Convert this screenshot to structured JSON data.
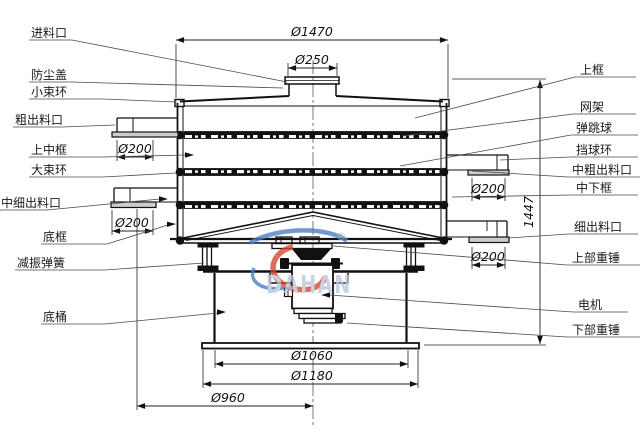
{
  "drawing": {
    "labels_left": [
      {
        "text": "进料口"
      },
      {
        "text": "防尘盖"
      },
      {
        "text": "小束环"
      },
      {
        "text": "粗出料口"
      },
      {
        "text": "上中框"
      },
      {
        "text": "大束环"
      },
      {
        "text": "中细出料口"
      },
      {
        "text": "底框"
      },
      {
        "text": "减振弹簧"
      },
      {
        "text": "底桶"
      }
    ],
    "labels_right": [
      {
        "text": "上框"
      },
      {
        "text": "网架"
      },
      {
        "text": "弹跳球"
      },
      {
        "text": "挡球环"
      },
      {
        "text": "中粗出料口"
      },
      {
        "text": "中下框"
      },
      {
        "text": "细出料口"
      },
      {
        "text": "上部重锤"
      },
      {
        "text": "电机"
      },
      {
        "text": "下部重锤"
      }
    ],
    "dimensions": {
      "top_diameter": "Ø1470",
      "inlet_diameter": "Ø250",
      "coarse_outlet_diameter": "Ø200",
      "mid_fine_outlet_diameter": "Ø200",
      "mid_coarse_outlet_diameter": "Ø200",
      "fine_outlet_diameter": "Ø200",
      "total_height": "1447",
      "base_inner_diameter": "Ø1060",
      "base_outer_diameter": "Ø1180",
      "outlet_span_diameter": "Ø960"
    },
    "watermark": {
      "brand": "DAHAN",
      "registered_mark": "®",
      "brand_color": "#b9c6d8",
      "swoosh_red": "#d6452f",
      "swoosh_blue": "#4a7dc0"
    },
    "colors": {
      "background": "#ffffff",
      "line": "#111111"
    }
  }
}
